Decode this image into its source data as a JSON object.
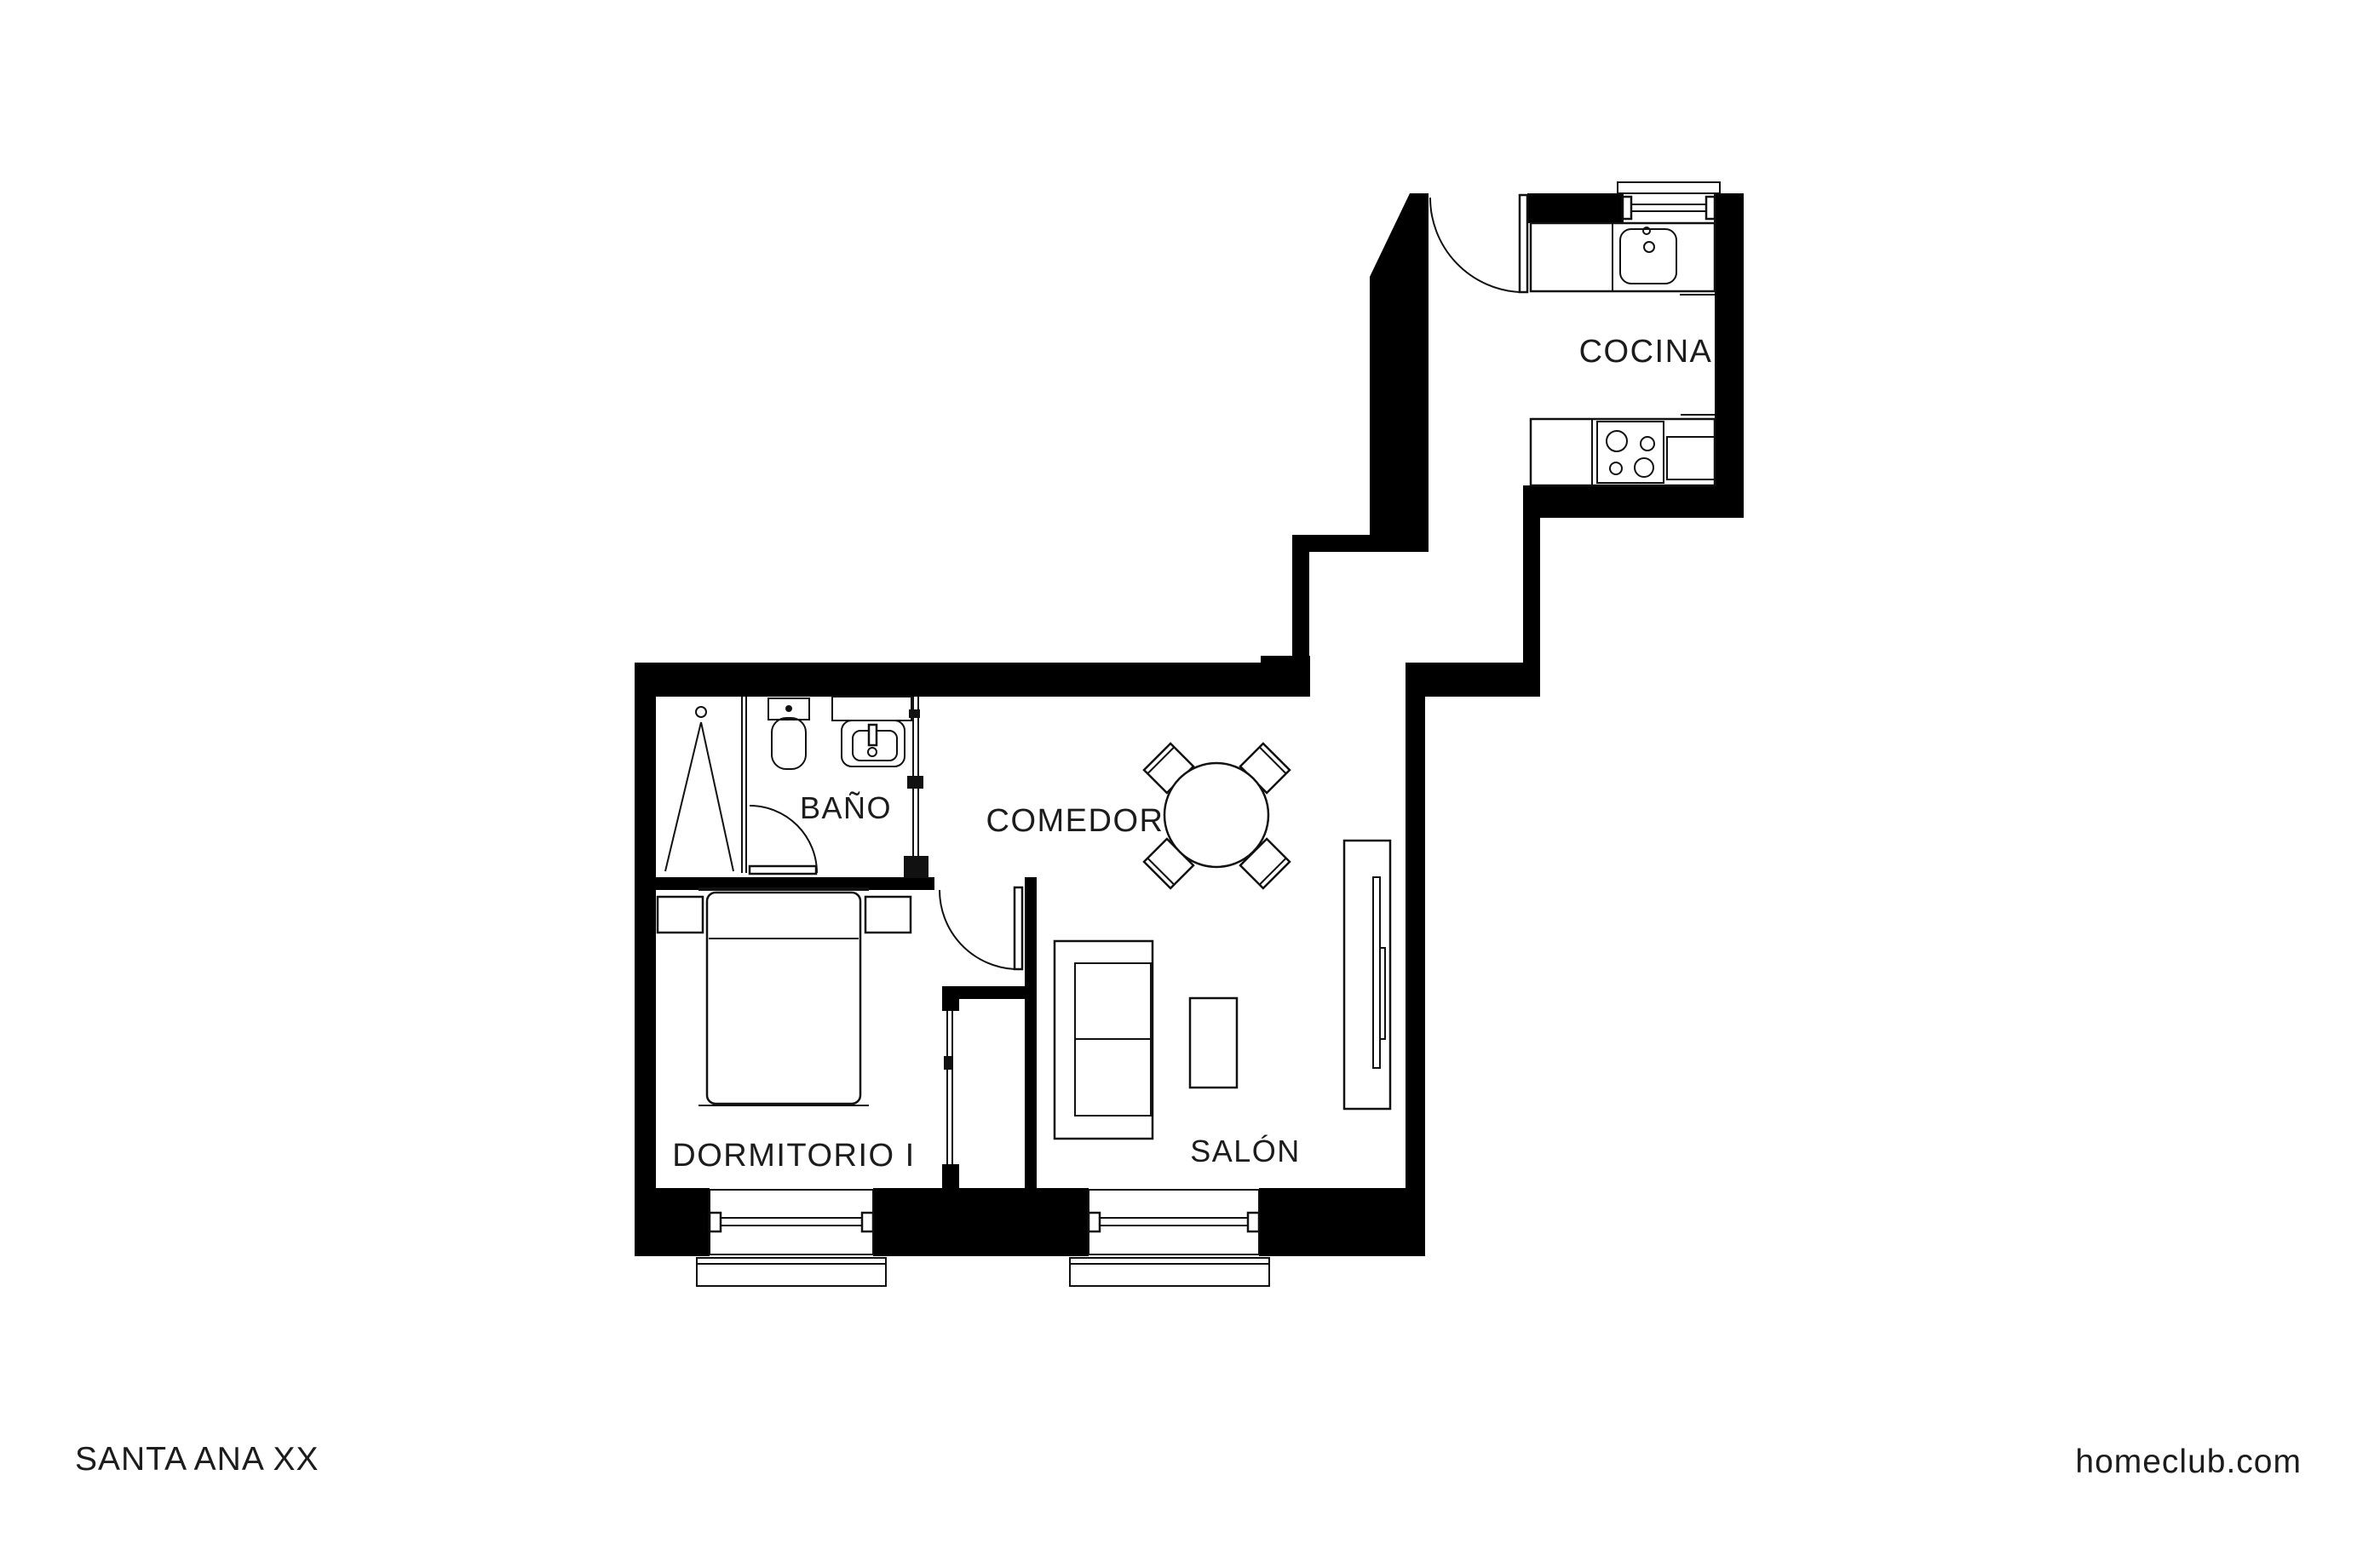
{
  "rooms": {
    "cocina": "COCINA",
    "bano": "BAÑO",
    "comedor": "COMEDOR",
    "dormitorio": "DORMITORIO I",
    "salon": "SALÓN"
  },
  "footer": {
    "left": "SANTA ANA XX",
    "right": "homeclub.com"
  },
  "symbols": {
    "shower": "shower-icon",
    "toilet": "toilet-icon",
    "washbasin": "washbasin-icon",
    "kitchen_sink": "kitchen-sink-icon",
    "stove": "stove-icon",
    "oven": "oven-icon",
    "dining_table": "round-table-icon",
    "chair": "chair-icon",
    "bed": "double-bed-icon",
    "nightstand": "nightstand-icon",
    "sofa": "sofa-icon",
    "coffee_table": "coffee-table-icon",
    "tv_unit": "tv-unit-icon",
    "window": "window-icon",
    "door": "door-swing-icon",
    "sliding_door": "sliding-door-icon"
  },
  "colors": {
    "ink": "#111111",
    "wall": "#000000",
    "background": "#ffffff"
  }
}
